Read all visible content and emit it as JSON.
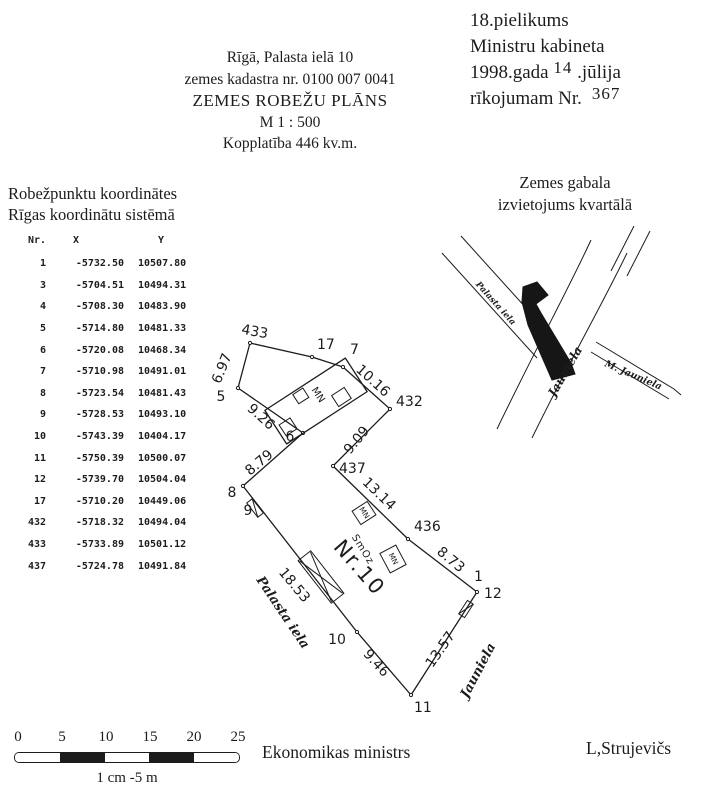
{
  "document": {
    "annex": {
      "line1": "18.pielikums",
      "line2": "Ministru kabineta",
      "line3_pre": "1998.gada",
      "line3_day": "14",
      "line3_post": ".jūlija",
      "line4_pre": "rīkojumam Nr.",
      "line4_num": "367"
    },
    "title_block": {
      "address": "Rīgā, Palasta ielā 10",
      "cadastre": "zemes kadastra nr. 0100 007 0041",
      "title": "ZEMES ROBEŽU PLĀNS",
      "scale": "M 1 : 500",
      "area": "Kopplatība 446 kv.m."
    },
    "coords_panel": {
      "heading1": "Robežpunktu koordinātes",
      "heading2": "Rīgas koordinātu sistēmā",
      "col_nr": "Nr.",
      "col_x": "X",
      "col_y": "Y",
      "rows": [
        [
          "1",
          "-5732.50",
          "10507.80"
        ],
        [
          "3",
          "-5704.51",
          "10494.31"
        ],
        [
          "4",
          "-5708.30",
          "10483.90"
        ],
        [
          "5",
          "-5714.80",
          "10481.33"
        ],
        [
          "6",
          "-5720.08",
          "10468.34"
        ],
        [
          "7",
          "-5710.98",
          "10491.01"
        ],
        [
          "8",
          "-5723.54",
          "10481.43"
        ],
        [
          "9",
          "-5728.53",
          "10493.10"
        ],
        [
          "10",
          "-5743.39",
          "10404.17"
        ],
        [
          "11",
          "-5750.39",
          "10500.07"
        ],
        [
          "12",
          "-5739.70",
          "10504.04"
        ],
        [
          "17",
          "-5710.20",
          "10449.06"
        ],
        [
          "432",
          "-5718.32",
          "10494.04"
        ],
        [
          "433",
          "-5733.89",
          "10501.12"
        ],
        [
          "437",
          "-5724.78",
          "10491.84"
        ]
      ]
    },
    "location_map": {
      "heading1": "Zemes gabala",
      "heading2": "izvietojums kvartālā",
      "street_palasta": "Palasta iela",
      "street_jauniela": "Jauniela",
      "street_m_jauniela": "M. Jauniela"
    },
    "plan": {
      "points": {
        "p433": "433",
        "p17": "17",
        "p7": "7",
        "p432": "432",
        "p437": "437",
        "p436": "436",
        "p1": "1",
        "p12": "12",
        "p11": "11",
        "p10": "10",
        "p9": "9",
        "p8": "8",
        "p6": "6",
        "p5": "5"
      },
      "distances": {
        "d5_433": "6.97",
        "d7_432": "10.16",
        "d432_437": "9.09",
        "d437_436": "13.14",
        "d436_12": "8.73",
        "d12_11": "13.57",
        "d11_10": "9.46",
        "d9_10": "18.53",
        "d8_6": "8.79",
        "d6_5": "9.26"
      },
      "building_label": "MN",
      "annotation_smoz": "SmOz",
      "parcel_number": "Nr.10",
      "street_palasta": "Palasta iela",
      "street_jauniela": "Jauniela"
    },
    "scale_bar": {
      "ticks": [
        "0",
        "5",
        "10",
        "15",
        "20",
        "25"
      ],
      "caption": "1 cm -5 m"
    },
    "footer": {
      "minister_title": "Ekonomikas ministrs",
      "minister_name": "L,Strujevičs"
    }
  }
}
